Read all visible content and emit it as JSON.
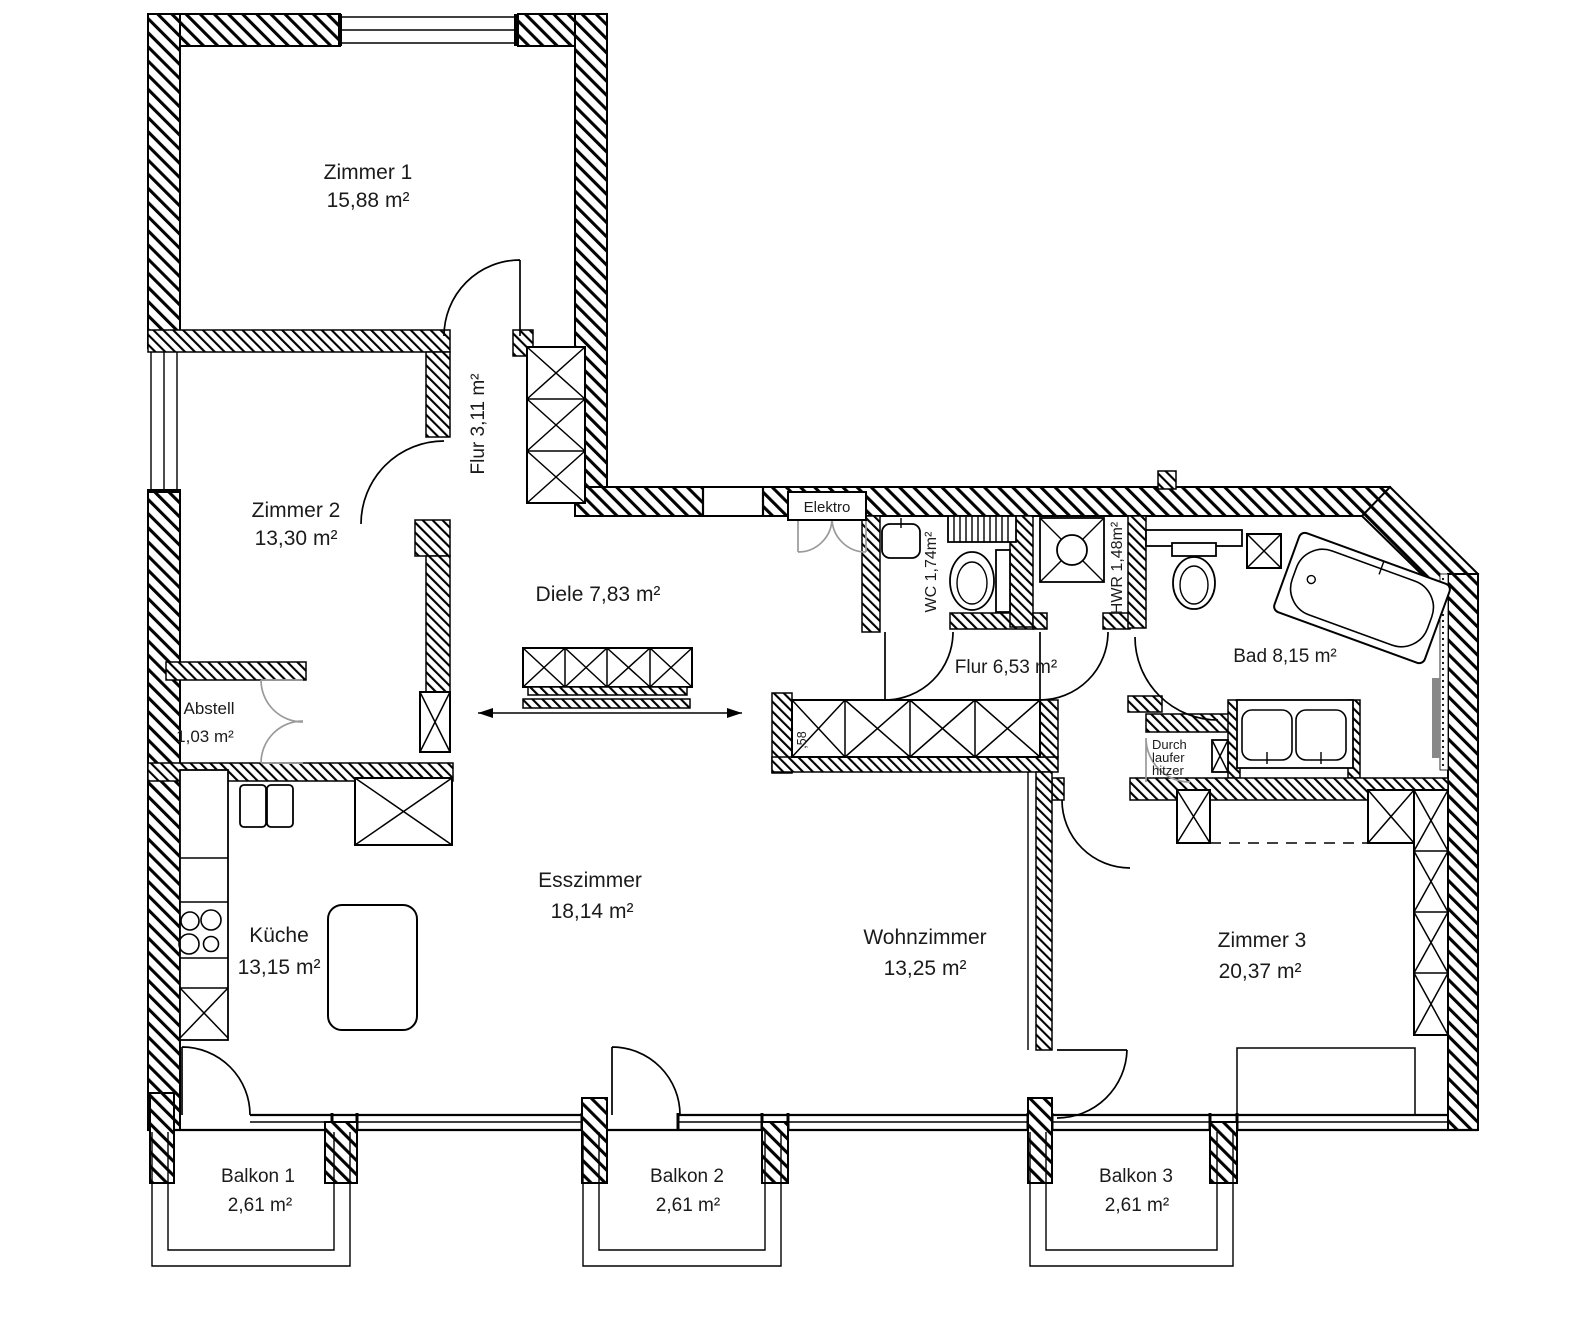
{
  "plan": {
    "title": "Wohnungsgrundriss",
    "rooms": {
      "zimmer1": {
        "name": "Zimmer 1",
        "area": "15,88 m²"
      },
      "zimmer2": {
        "name": "Zimmer 2",
        "area": "13,30 m²"
      },
      "flur_klein": {
        "label": "Flur 3,11 m²"
      },
      "diele": {
        "label": "Diele 7,83 m²"
      },
      "abstell": {
        "name": "Abstell",
        "area": "1,03 m²"
      },
      "kueche": {
        "name": "Küche",
        "area": "13,15 m²"
      },
      "esszimmer": {
        "name": "Esszimmer",
        "area": "18,14 m²"
      },
      "wohnzimmer": {
        "name": "Wohnzimmer",
        "area": "13,25 m²"
      },
      "zimmer3": {
        "name": "Zimmer 3",
        "area": "20,37 m²"
      },
      "wc": {
        "label": "WC 1,74m²"
      },
      "hwr": {
        "label": "HWR 1,48m²"
      },
      "flur_gross": {
        "label": "Flur 6,53 m²"
      },
      "bad": {
        "label": "Bad 8,15 m²"
      },
      "elektro": {
        "label": "Elektro"
      },
      "balkon1": {
        "name": "Balkon 1",
        "area": "2,61 m²"
      },
      "balkon2": {
        "name": "Balkon 2",
        "area": "2,61 m²"
      },
      "balkon3": {
        "name": "Balkon 3",
        "area": "2,61 m²"
      }
    },
    "annotations": {
      "durchlauferhitzer": [
        "Durch",
        "laufer",
        "hitzer"
      ],
      "wardrobe_depth": ",58"
    },
    "colors": {
      "ink": "#000000",
      "paper": "#ffffff",
      "secondary_door": "#9a9a9a"
    }
  }
}
